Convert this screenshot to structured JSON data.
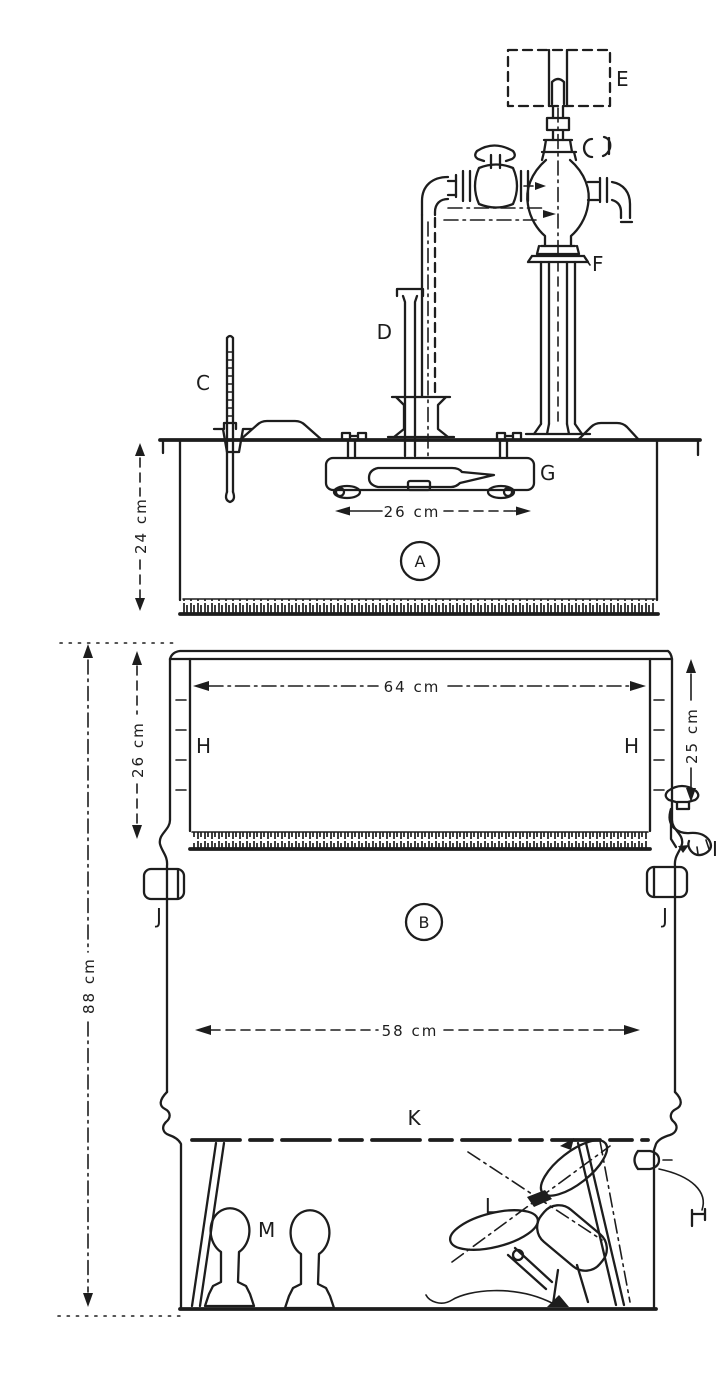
{
  "figure": {
    "description": "Hand-drawn cross-section diagram of a two-part laboratory incubator/stirrer apparatus, parts labelled A to M with centimetre dimensions",
    "colors": {
      "ink": "#1d1d1d",
      "paper": "#ffffff"
    }
  },
  "part_labels": {
    "a": "A",
    "b": "B",
    "c": "C",
    "d": "D",
    "e": "E",
    "f": "F",
    "g": "G",
    "h_left": "H",
    "h_right": "H",
    "i": "I",
    "j_left": "J",
    "j_right": "J",
    "k": "K",
    "l": "L",
    "m": "M"
  },
  "dimensions": {
    "upper_chamber_depth": "24 cm",
    "tray_width": "26 cm",
    "jacket_inner_width": "64 cm",
    "jacket_depth_left": "26 cm",
    "jacket_depth_right": "25 cm",
    "body_inner_width": "58 cm",
    "lower_unit_height": "88 cm"
  }
}
